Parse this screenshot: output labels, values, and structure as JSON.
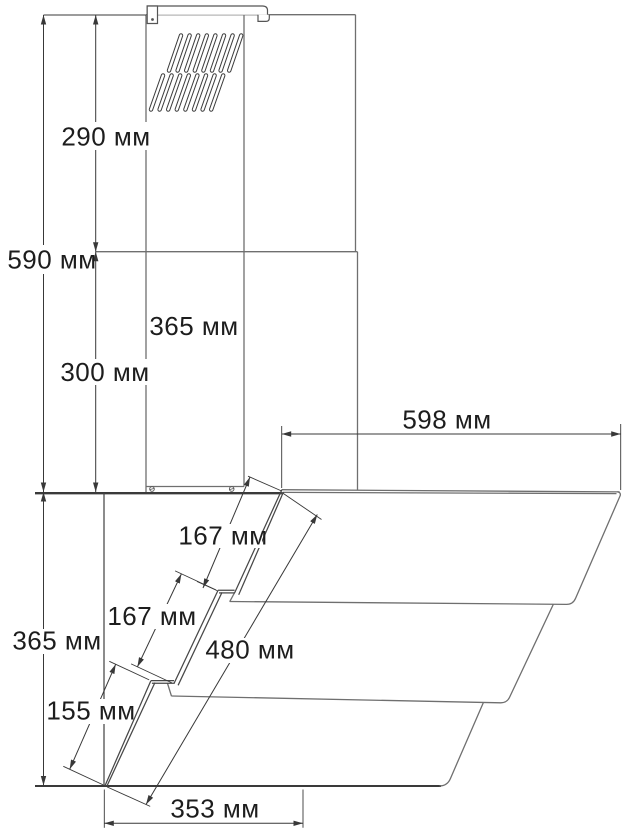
{
  "drawing": {
    "subject": "range-hood-dimension-drawing",
    "unit": "мм",
    "line_color": "#6f6f6f",
    "dim_color": "#383838",
    "text_color": "#1d1d1d",
    "background": "#ffffff",
    "dims": {
      "chimney_upper_height": {
        "value": 290,
        "text": "290 мм"
      },
      "chimney_total_height": {
        "value": 590,
        "text": "590 мм"
      },
      "chimney_lower_height": {
        "value": 300,
        "text": "300 мм"
      },
      "chimney_width": {
        "value": 365,
        "text": "365 мм"
      },
      "top_depth": {
        "value": 598,
        "text": "598 мм"
      },
      "glass_upper_segment": {
        "value": 167,
        "text": "167 мм"
      },
      "glass_middle_segment": {
        "value": 167,
        "text": "167 мм"
      },
      "glass_length": {
        "value": 480,
        "text": "480 мм"
      },
      "body_height": {
        "value": 365,
        "text": "365 мм"
      },
      "glass_lower_segment": {
        "value": 155,
        "text": "155 мм"
      },
      "bottom_depth": {
        "value": 353,
        "text": "353 мм"
      }
    }
  }
}
